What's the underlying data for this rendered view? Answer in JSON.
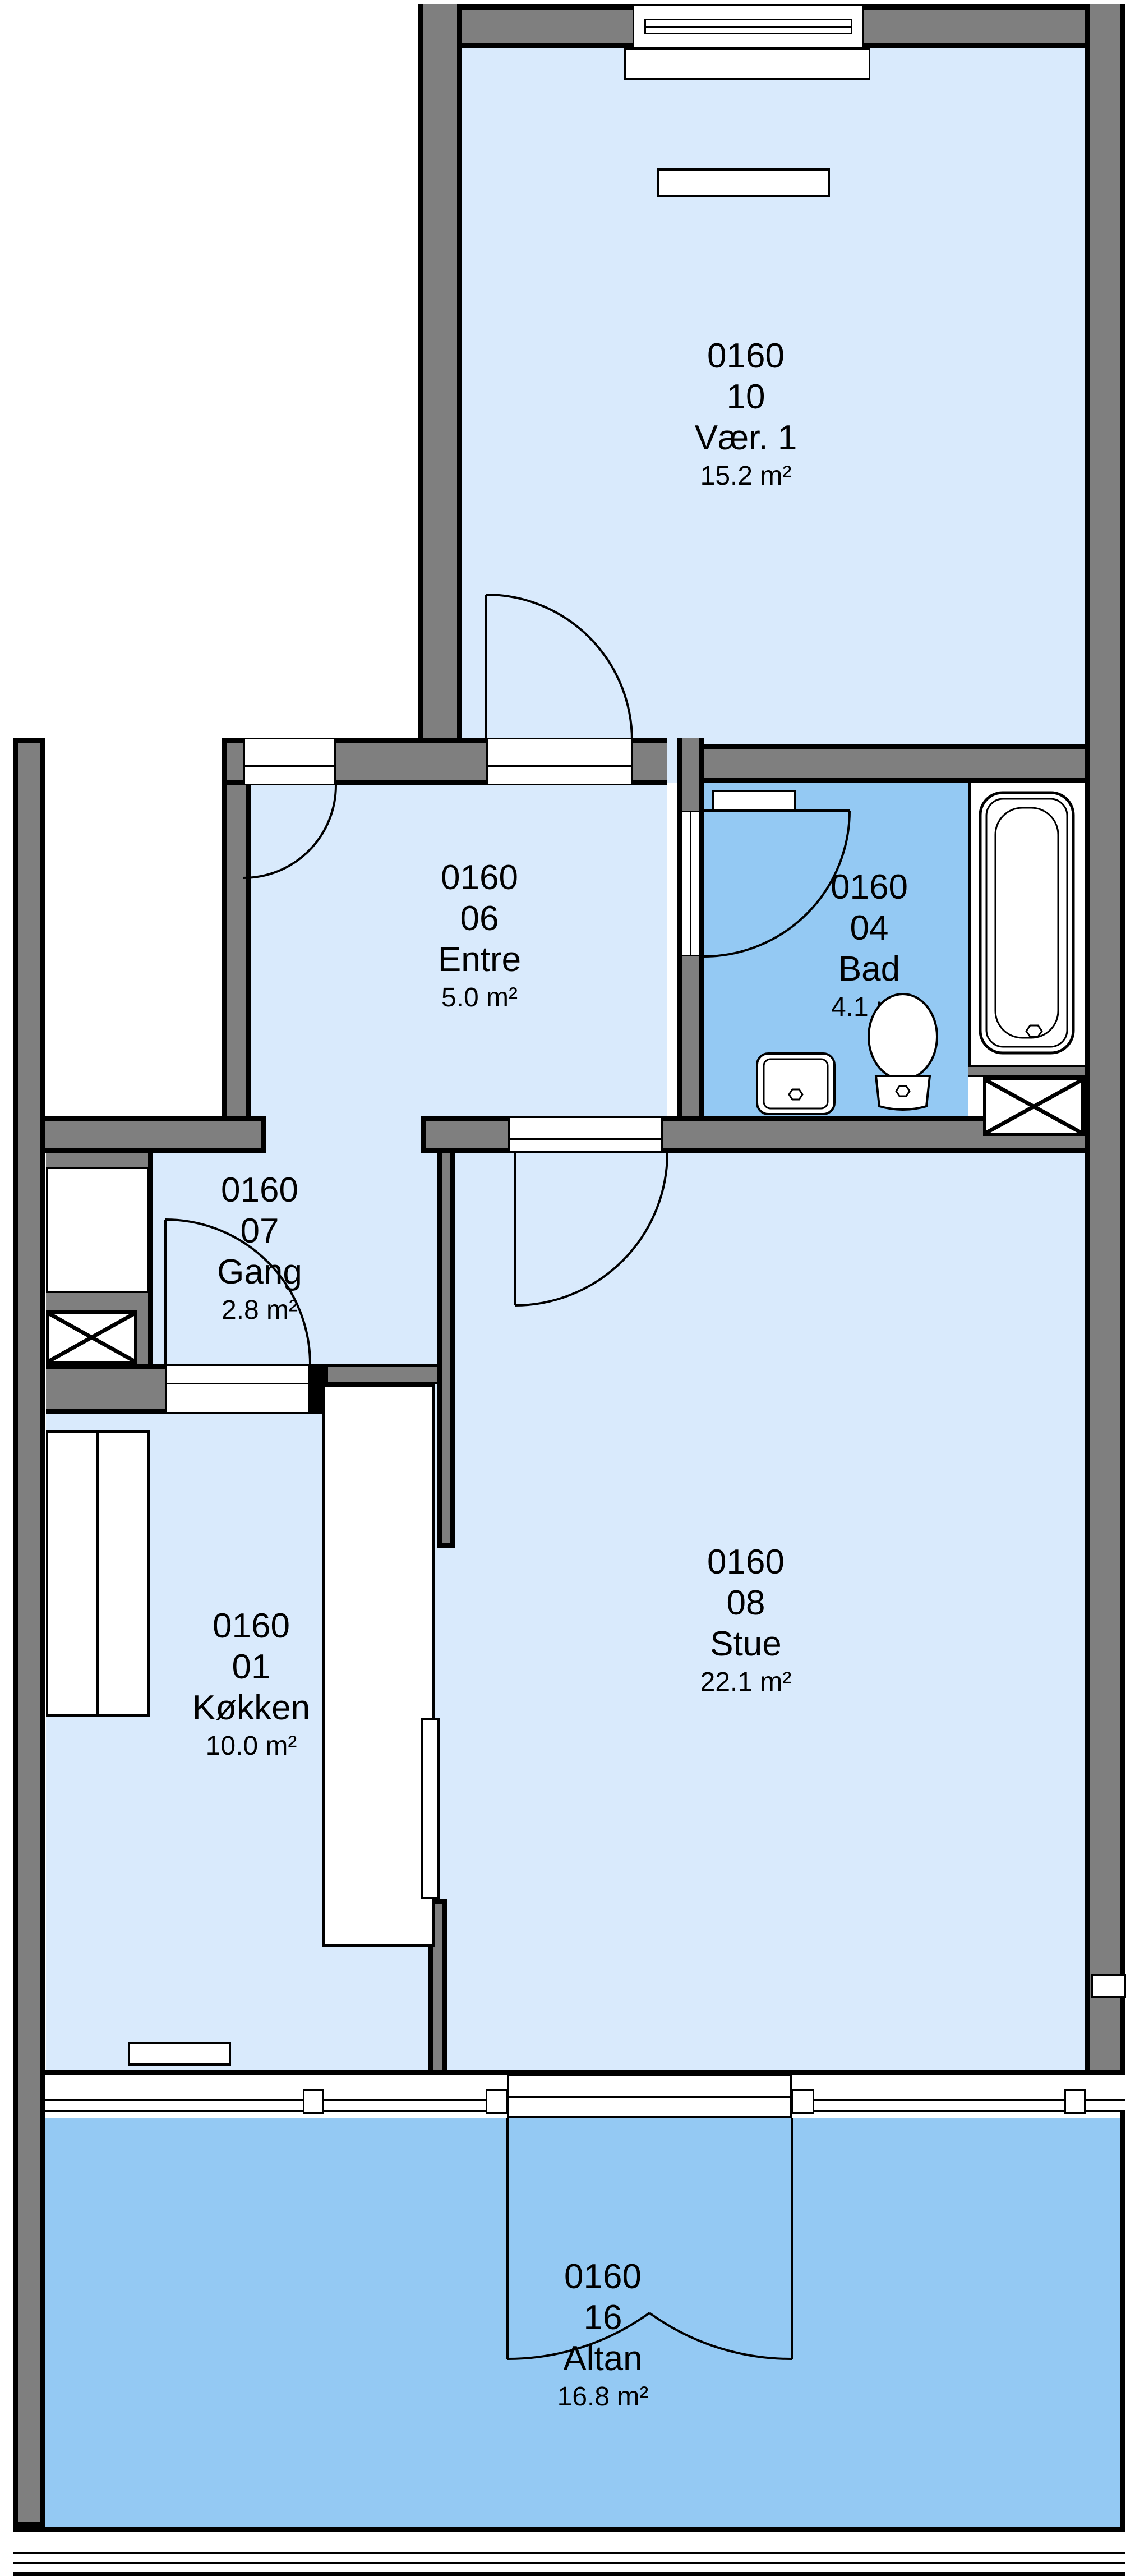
{
  "plan": {
    "title": "Apartment floor plan 0160",
    "rooms": [
      {
        "id": "vaer1",
        "unit": "0160",
        "number": "10",
        "name": "Vær. 1",
        "area": "15.2 m²"
      },
      {
        "id": "entre",
        "unit": "0160",
        "number": "06",
        "name": "Entre",
        "area": "5.0 m²"
      },
      {
        "id": "bad",
        "unit": "0160",
        "number": "04",
        "name": "Bad",
        "area": "4.1 m²"
      },
      {
        "id": "gang",
        "unit": "0160",
        "number": "07",
        "name": "Gang",
        "area": "2.8 m²"
      },
      {
        "id": "koekken",
        "unit": "0160",
        "number": "01",
        "name": "Køkken",
        "area": "10.0 m²"
      },
      {
        "id": "stue",
        "unit": "0160",
        "number": "08",
        "name": "Stue",
        "area": "22.1 m²"
      },
      {
        "id": "altan",
        "unit": "0160",
        "number": "16",
        "name": "Altan",
        "area": "16.8 m²"
      }
    ],
    "colors": {
      "wall": "#7f7f7f",
      "line": "#000000",
      "room_fill": "#d9eafc",
      "wet_fill": "#94c9f3"
    }
  }
}
